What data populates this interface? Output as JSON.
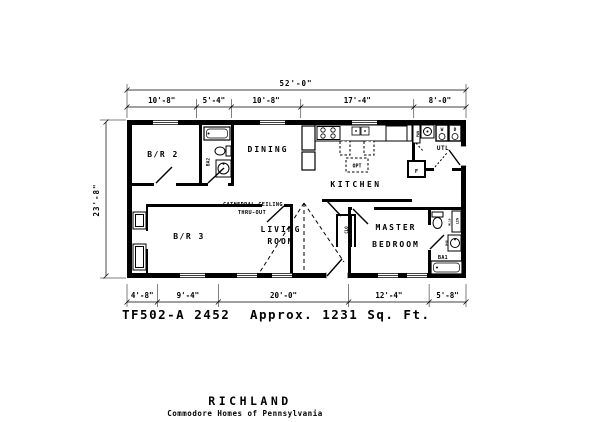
{
  "colors": {
    "ink": "#000000",
    "paper": "#ffffff"
  },
  "dimensions": {
    "overall_width": "52'-0\"",
    "overall_depth": "23'-8\"",
    "top_segments": [
      "10'-8\"",
      "5'-4\"",
      "10'-8\"",
      "17'-4\"",
      "8'-0\""
    ],
    "bottom_segments": [
      "4'-8\"",
      "9'-4\"",
      "20'-0\"",
      "12'-4\"",
      "5'-8\""
    ]
  },
  "rooms": {
    "br2": "B/R 2",
    "br3": "B/R 3",
    "dining": "DINING",
    "kitchen": "KITCHEN",
    "living_line1": "LIVING",
    "living_line2": "ROOM",
    "master_line1": "MASTER",
    "master_line2": "BEDROOM",
    "utility": "UTL",
    "bath1": "BA1",
    "bath2": "BA2"
  },
  "labels": {
    "cathedral_line1": "CATHEDRAL CEILING",
    "cathedral_line2": "THRU-OUT",
    "opt": "OPT",
    "furnace": "F",
    "washer": "W",
    "dryer": "D",
    "pantry": "PAN",
    "linen": "LIN",
    "closet": "CLO",
    "cab1": "ML18",
    "cab2": "M48"
  },
  "title_block": {
    "model": "TF502-A 2452",
    "area": "Approx. 1231 Sq. Ft.",
    "plan_name": "RICHLAND",
    "company": "Commodore Homes of Pennsylvania"
  }
}
